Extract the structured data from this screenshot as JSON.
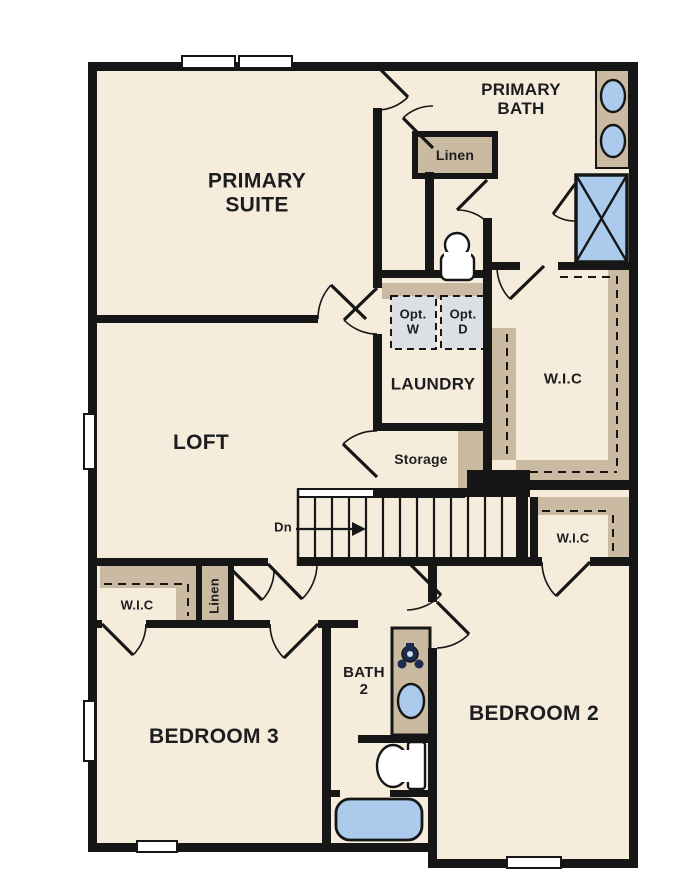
{
  "floor_plan": {
    "colors": {
      "background": "#ffffff",
      "floor": "#f5ecdc",
      "wall": "#161616",
      "cabinet_tan": "#c9baa1",
      "fixture_blue": "#abcaec",
      "optional_appliance_fill": "#dce0e4",
      "faucet_navy": "#1d2c4e",
      "text": "#1d1d1f"
    },
    "rooms": {
      "primary_suite": "PRIMARY\nSUITE",
      "primary_bath": "PRIMARY\nBATH",
      "loft": "LOFT",
      "laundry": "LAUNDRY",
      "storage": "Storage",
      "wic_main": "W.I.C",
      "wic_hall": "W.I.C",
      "wic_bedroom3": "W.I.C",
      "linen_bath": "Linen",
      "linen_hall": "Linen",
      "bath2": "BATH\n2",
      "bedroom2": "BEDROOM 2",
      "bedroom3": "BEDROOM 3",
      "opt_washer": "Opt.\nW",
      "opt_dryer": "Opt.\nD",
      "stairs_direction": "Dn"
    }
  }
}
